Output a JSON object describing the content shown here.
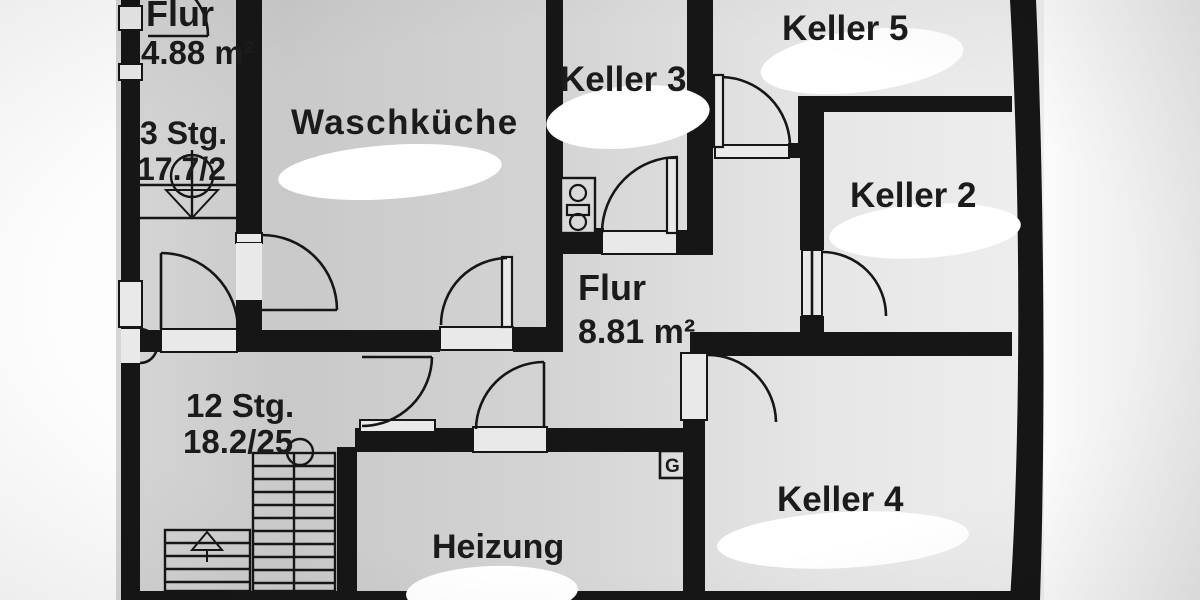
{
  "title": "Kellergeschoss Grundriss (basement floor plan photo)",
  "rooms": [
    {
      "name": "Flur",
      "area": "4.88 m²"
    },
    {
      "name": "Waschküche",
      "area": ""
    },
    {
      "name": "Keller 3",
      "area": ""
    },
    {
      "name": "Keller 5",
      "area": ""
    },
    {
      "name": "Keller 2",
      "area": ""
    },
    {
      "name": "Flur",
      "area": "8.81 m²"
    },
    {
      "name": "Keller 4",
      "area": ""
    },
    {
      "name": "Heizung",
      "area": ""
    }
  ],
  "stairs": [
    {
      "label": "12 Stg.",
      "spec": "18.2/25"
    },
    {
      "label": "3 Stg.",
      "spec": "17.7/2"
    }
  ],
  "symbols": {
    "gas_meter_label": "G",
    "meter_box": "electric-meter-symbol",
    "redactions": "white correction-fluid blobs hiding area values in Waschküche, Keller 2, Keller 3, Keller 4, Keller 5, Heizung"
  },
  "colors": {
    "wall": "#161616",
    "paper_dark": "#c7c7c7",
    "paper_light": "#ededed",
    "outside": "#fdfdfd",
    "redaction": "#ffffff",
    "text": "#1b1b1b"
  }
}
